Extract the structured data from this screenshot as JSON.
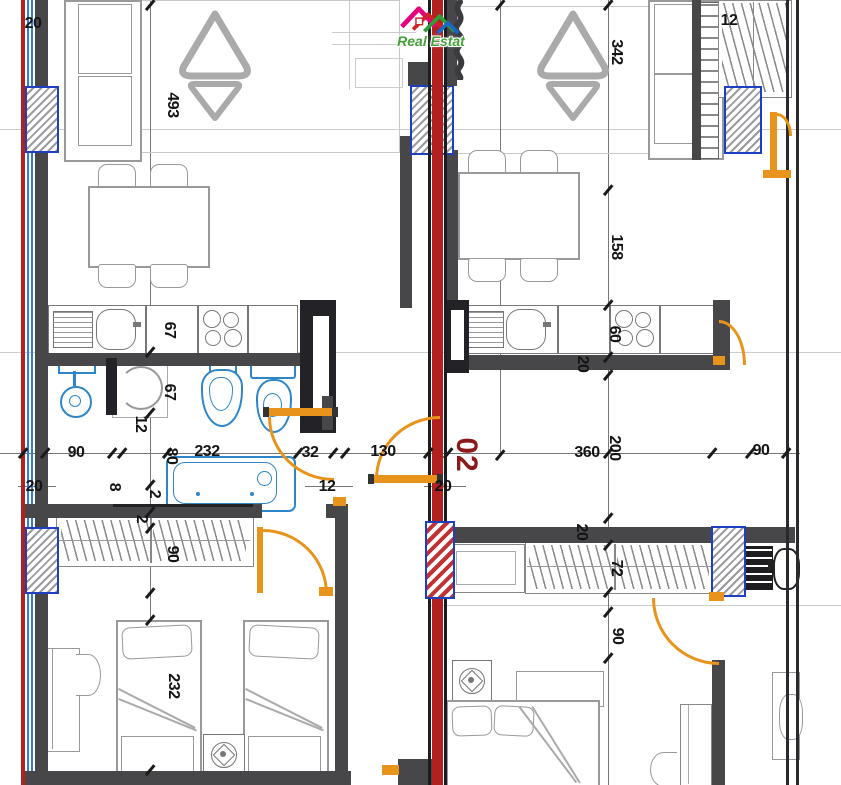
{
  "meta": {
    "type": "architectural-floor-plan",
    "watermark_text": "Real Estat",
    "unit_label": "02"
  },
  "colors": {
    "wall_gray": "#47474a",
    "wall_black": "#232327",
    "section_line_red": "#b22020",
    "door_orange": "#e8941c",
    "window_border_blue": "#1e3fbf",
    "fixture_blue": "#2e86c8",
    "unit_label_red": "#8b1a1a",
    "dimension_text": "#141414",
    "furniture_gray": "#999999"
  },
  "dimension_labels": [
    {
      "text": "20",
      "x": 33,
      "y": 24,
      "rot": 0
    },
    {
      "text": "493",
      "x": 172,
      "y": 105,
      "rot": 90
    },
    {
      "text": "342",
      "x": 616,
      "y": 52,
      "rot": 90
    },
    {
      "text": "12",
      "x": 729,
      "y": 21,
      "rot": 0
    },
    {
      "text": "158",
      "x": 616,
      "y": 247,
      "rot": 90
    },
    {
      "text": "67",
      "x": 169,
      "y": 330,
      "rot": 90
    },
    {
      "text": "67",
      "x": 169,
      "y": 392,
      "rot": 90
    },
    {
      "text": "60",
      "x": 614,
      "y": 334,
      "rot": 90
    },
    {
      "text": "20",
      "x": 582,
      "y": 364,
      "rot": 90
    },
    {
      "text": "12",
      "x": 140,
      "y": 424,
      "rot": 90
    },
    {
      "text": "2",
      "x": 154,
      "y": 494,
      "rot": 90
    },
    {
      "text": "2",
      "x": 141,
      "y": 519,
      "rot": 90
    },
    {
      "text": "90",
      "x": 76,
      "y": 453,
      "rot": 0
    },
    {
      "text": "8",
      "x": 114,
      "y": 487,
      "rot": 90
    },
    {
      "text": "20",
      "x": 34,
      "y": 487,
      "rot": 0
    },
    {
      "text": "80",
      "x": 171,
      "y": 456,
      "rot": 90
    },
    {
      "text": "232",
      "x": 207,
      "y": 452,
      "rot": 0
    },
    {
      "text": "32",
      "x": 310,
      "y": 453,
      "rot": 0
    },
    {
      "text": "12",
      "x": 327,
      "y": 487,
      "rot": 0
    },
    {
      "text": "130",
      "x": 383,
      "y": 452,
      "rot": 0
    },
    {
      "text": "20",
      "x": 443,
      "y": 487,
      "rot": 0
    },
    {
      "text": "360",
      "x": 587,
      "y": 453,
      "rot": 0
    },
    {
      "text": "200",
      "x": 614,
      "y": 448,
      "rot": 90
    },
    {
      "text": "90",
      "x": 761,
      "y": 451,
      "rot": 0
    },
    {
      "text": "90",
      "x": 172,
      "y": 554,
      "rot": 90
    },
    {
      "text": "232",
      "x": 173,
      "y": 686,
      "rot": 90
    },
    {
      "text": "20",
      "x": 581,
      "y": 532,
      "rot": 90
    },
    {
      "text": "72",
      "x": 616,
      "y": 568,
      "rot": 90
    },
    {
      "text": "90",
      "x": 617,
      "y": 636,
      "rot": 90
    }
  ],
  "ticks": [
    [
      23,
      453
    ],
    [
      45,
      453
    ],
    [
      112,
      453
    ],
    [
      122,
      453
    ],
    [
      167,
      453
    ],
    [
      298,
      453
    ],
    [
      333,
      453
    ],
    [
      345,
      453
    ],
    [
      428,
      453
    ],
    [
      448,
      453
    ],
    [
      608,
      453
    ],
    [
      712,
      453
    ],
    [
      750,
      453
    ],
    [
      786,
      453
    ],
    [
      150,
      5
    ],
    [
      150,
      352
    ],
    [
      150,
      413
    ],
    [
      150,
      485
    ],
    [
      150,
      512
    ],
    [
      150,
      528
    ],
    [
      150,
      593
    ],
    [
      150,
      620
    ],
    [
      150,
      770
    ],
    [
      608,
      5
    ],
    [
      608,
      190
    ],
    [
      608,
      305
    ],
    [
      608,
      357
    ],
    [
      608,
      375
    ],
    [
      608,
      518
    ],
    [
      608,
      545
    ],
    [
      608,
      592
    ],
    [
      608,
      612
    ],
    [
      608,
      658
    ],
    [
      500,
      5
    ],
    [
      500,
      455
    ]
  ],
  "symbols": [
    "sofa",
    "armchair-triangle",
    "dining-table",
    "dining-chair",
    "kitchen-sink",
    "cooktop-stove",
    "kitchen-cabinet",
    "shower",
    "washing-machine",
    "bidet",
    "toilet",
    "bathtub",
    "wardrobe-hanging",
    "single-bed",
    "double-bed",
    "nightstand-lamp",
    "desk",
    "desk-chair",
    "radiator",
    "plant-symbol",
    "door-swing",
    "window",
    "duct-shaft",
    "section-line"
  ]
}
